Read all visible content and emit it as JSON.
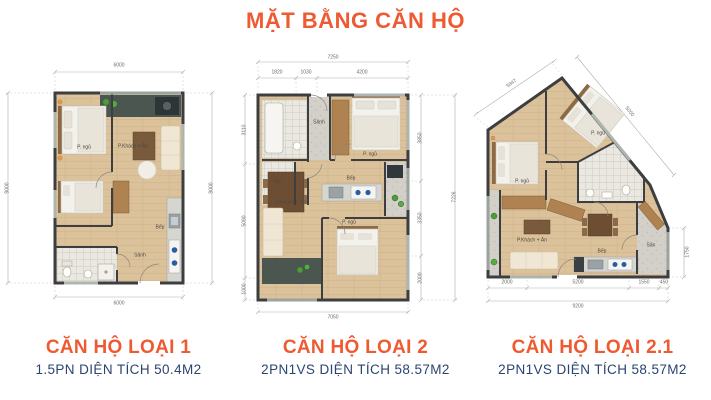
{
  "page": {
    "title": "MẶT BẰNG CĂN HỘ"
  },
  "colors": {
    "accent_orange": "#EE5A31",
    "navy": "#2B4470"
  },
  "plans": [
    {
      "title": "CĂN HỘ LOẠI 1",
      "subtitle": "1.5PN DIỆN TÍCH 50.4M2",
      "dims": {
        "top": "6000",
        "bottom": "6000",
        "left": "9000",
        "right": "9000"
      },
      "rooms": {
        "bedroom": "P. ngủ",
        "living": "P.Khách + Ăn",
        "kitchen": "Bếp",
        "hall": "Sảnh"
      }
    },
    {
      "title": "CĂN HỘ LOẠI 2",
      "subtitle": "2PN1VS DIỆN TÍCH 58.57M2",
      "dims": {
        "top_total": "7250",
        "top_1": "1820",
        "top_2": "1030",
        "top_3": "4200",
        "left_1": "3110",
        "left_2": "5090",
        "left_3": "1000",
        "right_1": "3850",
        "right_2": "3350",
        "right_3": "2000",
        "right_total": "7226",
        "bottom_total": "7050"
      },
      "rooms": {
        "hall": "Sảnh",
        "wc": "WC",
        "kitchen": "Bếp",
        "bedroom1": "P. ngủ",
        "bedroom2": "P. ngủ",
        "living": "P.Khách + Ăn"
      }
    },
    {
      "title": "CĂN HỘ LOẠI 2.1",
      "subtitle": "2PN1VS DIỆN TÍCH 58.57M2",
      "dims": {
        "slant_left": "5947",
        "slant_right": "5000",
        "right": "1750",
        "bottom_1": "2000",
        "bottom_2": "5200",
        "bottom_3": "1550",
        "bottom_4": "450",
        "bottom_total": "9200"
      },
      "rooms": {
        "bedroom1": "P. ngủ",
        "bedroom2": "P. ngủ",
        "living": "P.Khách + Ăn",
        "kitchen": "Bếp",
        "balcony": "Sân"
      }
    }
  ]
}
